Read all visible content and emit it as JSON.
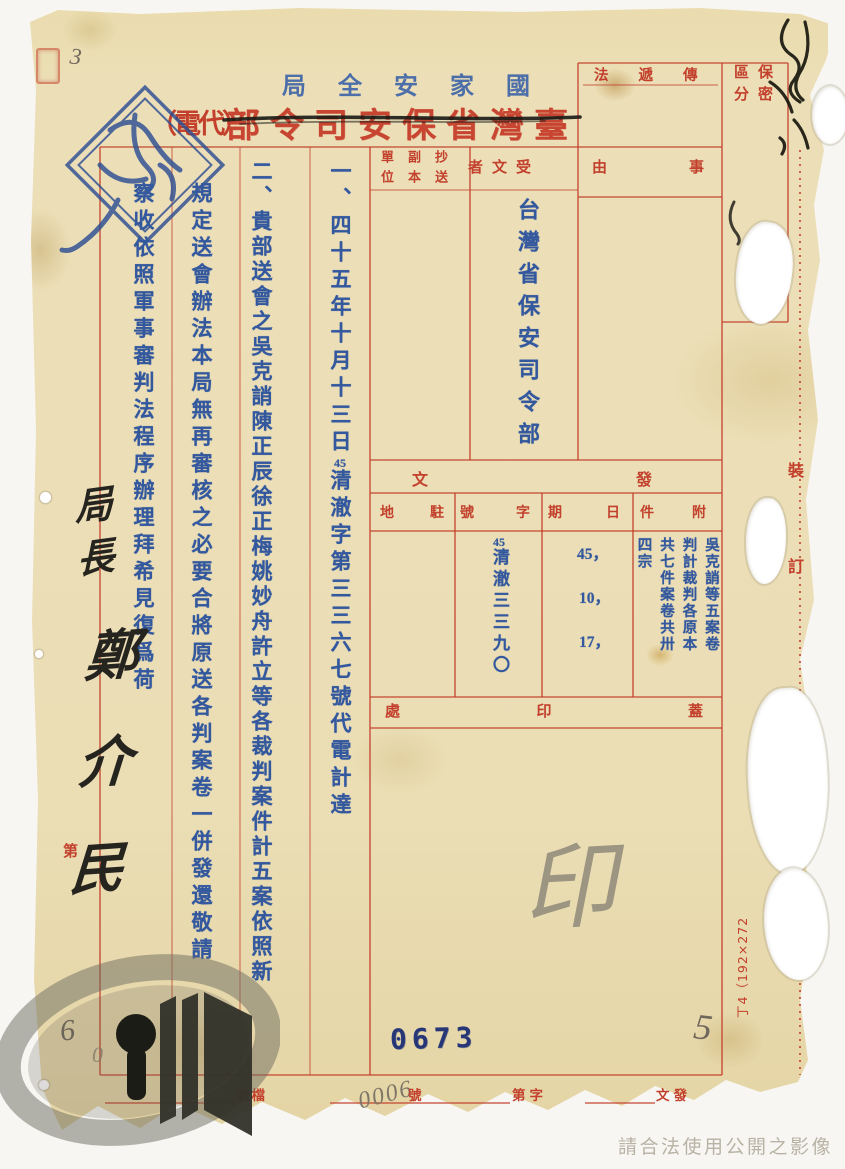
{
  "colors": {
    "print_red": "#c2402c",
    "type_blue": "#33589e",
    "stamp_blue": "#2d4f93",
    "ink_black": "#26241f",
    "pencil_gray": "#857b6a",
    "paper": "#ecdfb8"
  },
  "header": {
    "agency_stamp": "局全安家國",
    "org_title": "部令司安保省灣臺",
    "doc_type": "（電代）",
    "pencil_note": "3"
  },
  "boxes": {
    "transmission_label": "法遞傳",
    "classification_label": "保密區分",
    "subject_chars": [
      "由",
      "事"
    ],
    "recipient_label": "者文受",
    "cc_label": "抄送副本單位",
    "recipient_value": "台灣省保安司令部"
  },
  "body": {
    "item1_pre": "一、四十五年十月十三日",
    "item1_num": "45",
    "item1_post": "清澈字第三三六七號代電計達",
    "item2": "二、貴部送會之吳克誚陳正辰徐正梅姚妙舟許立等各裁判案件計五案依照新",
    "item3": "規定送會辦法本局無再審核之必要合將原送各判案卷一併發還敬請",
    "item4": "察收依照軍事審判法程序辦理拜希見復爲荷"
  },
  "dispatch": {
    "section_chars": [
      "文",
      "發"
    ],
    "col_labels": {
      "station": "地駐",
      "number": "號字",
      "date": "期日",
      "attachment": "件附"
    },
    "number_prefix": "45",
    "number_value": "清澈三三九〇",
    "dates": [
      "45，",
      "10，",
      "17，"
    ],
    "attachments": "吳克誚等五案卷判計裁判各原本共七件案卷共卅四宗"
  },
  "seal": {
    "label_chars": [
      "處",
      "印",
      "蓋"
    ],
    "pencil_char": "印",
    "pencil_number": "5"
  },
  "footer": {
    "stamp_number": "0673",
    "pencil_number": "0006",
    "file_label": "號檔",
    "suffix_label": "號",
    "word_label": "第字",
    "dispatch_label": "文發"
  },
  "margins": {
    "binding_top": "裝",
    "binding_bottom": "訂",
    "form_code": "丁4（192×272",
    "ordinal": "第",
    "pencil_digits": [
      "6",
      "0"
    ]
  },
  "signature": {
    "title": "局長",
    "name": "鄭介民"
  },
  "watermark": {
    "notice": "請合法使用公開之影像"
  }
}
